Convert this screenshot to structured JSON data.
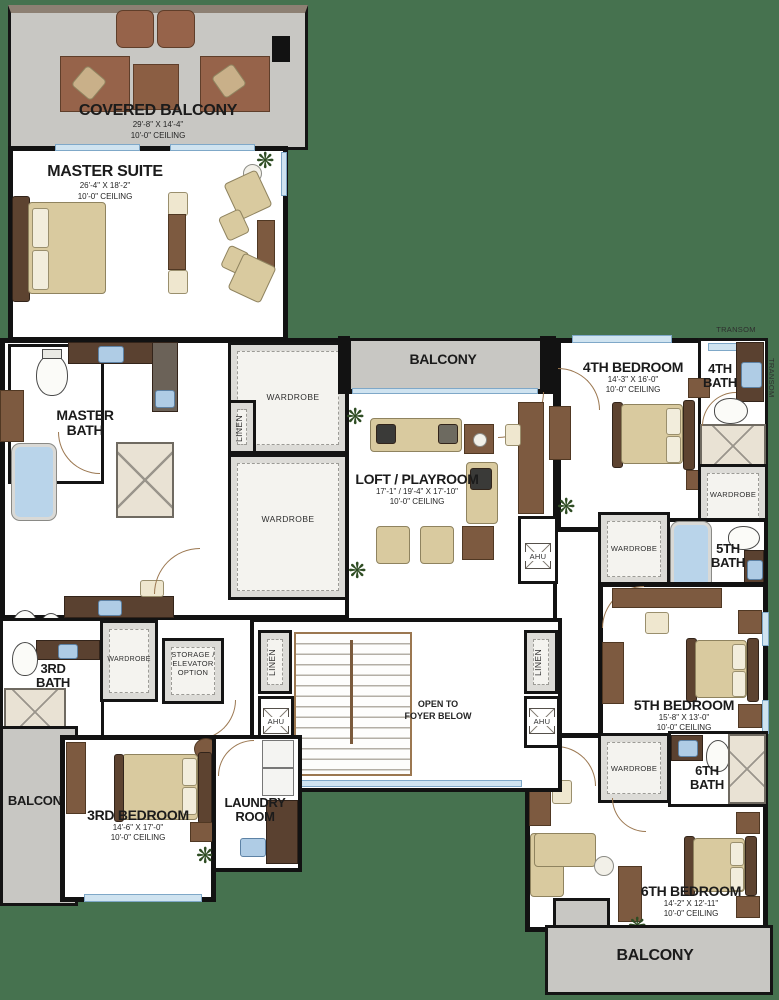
{
  "colors": {
    "background": "#46724F",
    "wall": "#121212",
    "room_fill": "#FFFFFF",
    "balcony_fill": "#C8C7C3",
    "closet_fill": "#DCDBD7",
    "wood": "#7D5A40",
    "counter": "#5A4130",
    "upholstery_tan": "#D9CA9F",
    "fixture_blue": "#AFCCE5",
    "window_blue": "#CFE3F0"
  },
  "rooms": {
    "covered_balcony": {
      "name": "COVERED BALCONY",
      "dims": "29'-8\" X 14'-4\"",
      "ceiling": "10'-0\" CEILING"
    },
    "master_suite": {
      "name": "MASTER SUITE",
      "dims": "26'-4\" X 18'-2\"",
      "ceiling": "10'-0\" CEILING"
    },
    "master_bath": {
      "line1": "MASTER",
      "line2": "BATH"
    },
    "balcony_mid": {
      "name": "BALCONY"
    },
    "loft": {
      "name": "LOFT / PLAYROOM",
      "dims": "17'-1\" / 19'-4\" X 17'-10\"",
      "ceiling": "10'-0\" CEILING"
    },
    "bedroom4": {
      "name": "4TH BEDROOM",
      "dims": "14'-3\" X 16'-0\"",
      "ceiling": "10'-0\" CEILING"
    },
    "bath4": {
      "line1": "4TH",
      "line2": "BATH"
    },
    "bath5": {
      "line1": "5TH",
      "line2": "BATH"
    },
    "bedroom5": {
      "name": "5TH BEDROOM",
      "dims": "15'-8\" X 13'-0\"",
      "ceiling": "10'-0\" CEILING"
    },
    "bath6": {
      "line1": "6TH",
      "line2": "BATH"
    },
    "bedroom6": {
      "name": "6TH BEDROOM",
      "dims": "14'-2\" X 12'-11\"",
      "ceiling": "10'-0\" CEILING"
    },
    "bedroom3": {
      "name": "3RD BEDROOM",
      "dims": "14'-6\" X 17'-0\"",
      "ceiling": "10'-0\" CEILING"
    },
    "bath3": {
      "line1": "3RD",
      "line2": "BATH"
    },
    "laundry": {
      "line1": "LAUNDRY",
      "line2": "ROOM"
    },
    "balcony_left": {
      "name": "BALCONY"
    },
    "balcony_bottom": {
      "name": "BALCONY"
    },
    "foyer": {
      "line1": "OPEN TO",
      "line2": "FOYER BELOW"
    },
    "storage": {
      "line1": "STORAGE /",
      "line2": "ELEVATOR",
      "line3": "OPTION"
    }
  },
  "labels": {
    "wardrobe": "WARDROBE",
    "linen": "LINEN",
    "ahu": "AHU",
    "transom": "TRANSOM"
  }
}
